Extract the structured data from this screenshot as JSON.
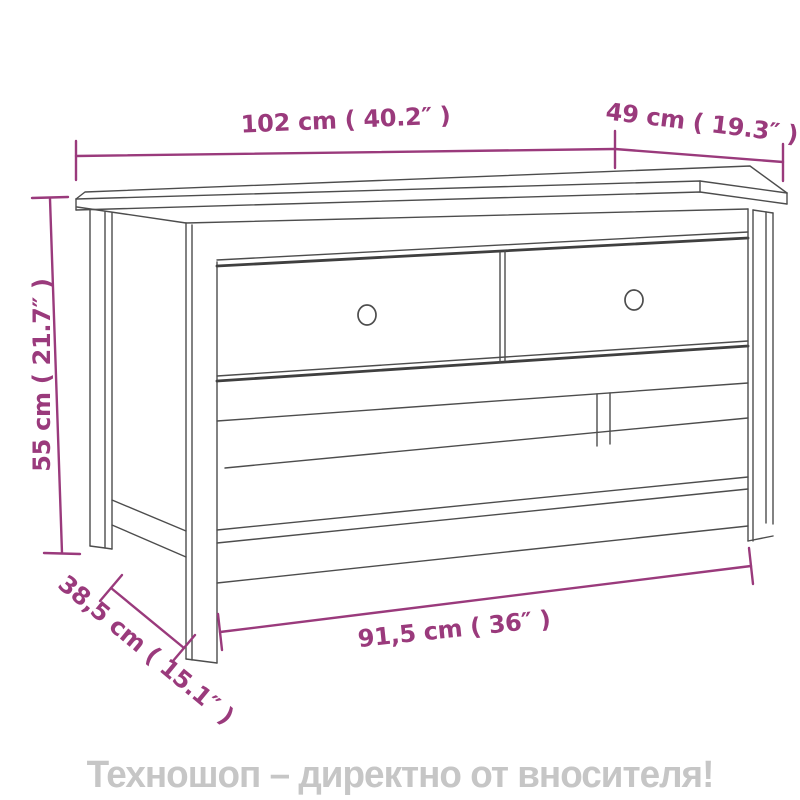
{
  "diagram": {
    "product": "coffee-table-with-two-drawers-and-shelf",
    "dimensions": {
      "width": "102 cm ( 40.2″ )",
      "depth": "49 cm ( 19.3″ )",
      "height": "55 cm ( 21.7″ )",
      "base_depth": "38,5 cm ( 15.1″ )",
      "base_width": "91,5 cm ( 36″ )"
    },
    "colors": {
      "dimension_accent": "#9a3a7c",
      "drawing_line": "#4d4d4d",
      "footer_text": "#c6c6c6",
      "background": "#ffffff"
    }
  },
  "footer": {
    "text": "Техношоп – директно от вносителя!"
  }
}
